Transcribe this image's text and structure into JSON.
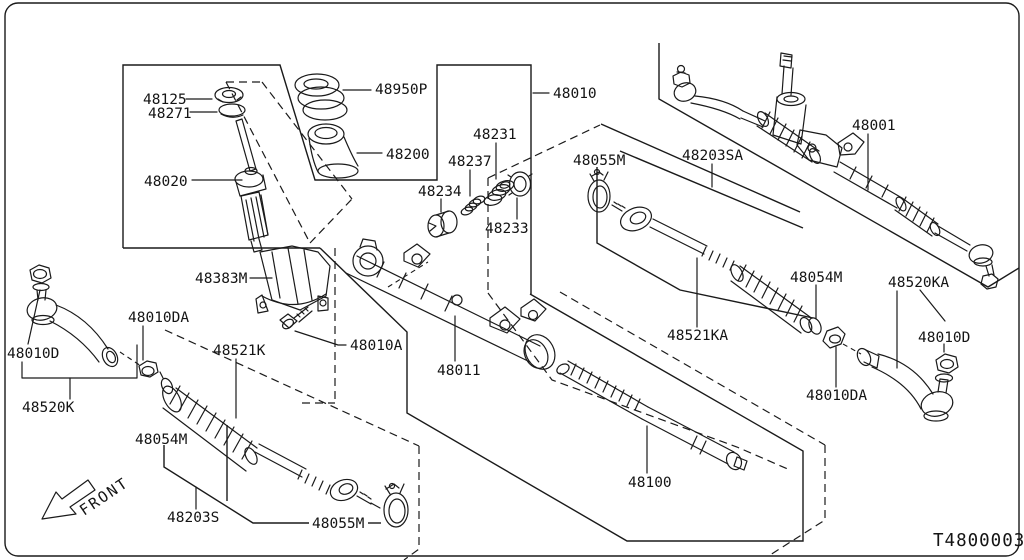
{
  "diagram": {
    "description": "Exploded parts diagram - manual steering gear and linkage",
    "drawing_code": "T4800003",
    "front_label": "FRONT",
    "colors": {
      "line": "#1a1a1a",
      "background": "#ffffff"
    },
    "labels": [
      {
        "id": "48125",
        "text": "48125"
      },
      {
        "id": "48271",
        "text": "48271"
      },
      {
        "id": "48020",
        "text": "48020"
      },
      {
        "id": "48950P",
        "text": "48950P"
      },
      {
        "id": "48200",
        "text": "48200"
      },
      {
        "id": "48010",
        "text": "48010"
      },
      {
        "id": "48231",
        "text": "48231"
      },
      {
        "id": "48237",
        "text": "48237"
      },
      {
        "id": "48234",
        "text": "48234"
      },
      {
        "id": "48233",
        "text": "48233"
      },
      {
        "id": "48055M-upper",
        "text": "48055M"
      },
      {
        "id": "48203SA",
        "text": "48203SA"
      },
      {
        "id": "48001",
        "text": "48001"
      },
      {
        "id": "48054M-right",
        "text": "48054M"
      },
      {
        "id": "48521KA",
        "text": "48521KA"
      },
      {
        "id": "48010DA-right",
        "text": "48010DA"
      },
      {
        "id": "48520KA",
        "text": "48520KA"
      },
      {
        "id": "48010D-right",
        "text": "48010D"
      },
      {
        "id": "48010D-left",
        "text": "48010D"
      },
      {
        "id": "48520K",
        "text": "48520K"
      },
      {
        "id": "48010DA-left",
        "text": "48010DA"
      },
      {
        "id": "48054M-left",
        "text": "48054M"
      },
      {
        "id": "48383M",
        "text": "48383M"
      },
      {
        "id": "48521K",
        "text": "48521K"
      },
      {
        "id": "48010A",
        "text": "48010A"
      },
      {
        "id": "48011",
        "text": "48011"
      },
      {
        "id": "48100",
        "text": "48100"
      },
      {
        "id": "48203S",
        "text": "48203S"
      },
      {
        "id": "48055M-lower",
        "text": "48055M"
      }
    ]
  }
}
